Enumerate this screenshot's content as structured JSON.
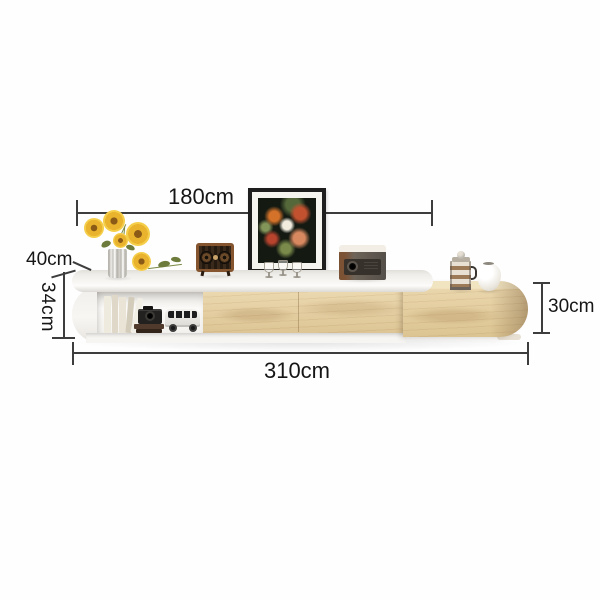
{
  "diagram": {
    "labels": {
      "top_width": "180cm",
      "depth": "40cm",
      "left_height": "34cm",
      "right_height": "30cm",
      "total_length": "310cm"
    },
    "line_color": "#3d3d3d",
    "text_color": "#161616"
  },
  "product": {
    "type": "tv-stand-dimension-diagram",
    "body_color": "#f6f5f2",
    "wood_color": "#e3cd9f",
    "accent_colors": {
      "sunflower_yellow": "#e9b32e",
      "radio_wood_brown": "#84552e",
      "frame_black": "#1e1e1e"
    },
    "decor_items": [
      "sunflowers-in-vase",
      "loose-sunflower",
      "vintage-radio-speaker",
      "framed-floral-painting",
      "wine-glasses",
      "projector",
      "shelf-books",
      "toy-camera",
      "toy-van",
      "french-press",
      "ceramic-jug"
    ]
  }
}
